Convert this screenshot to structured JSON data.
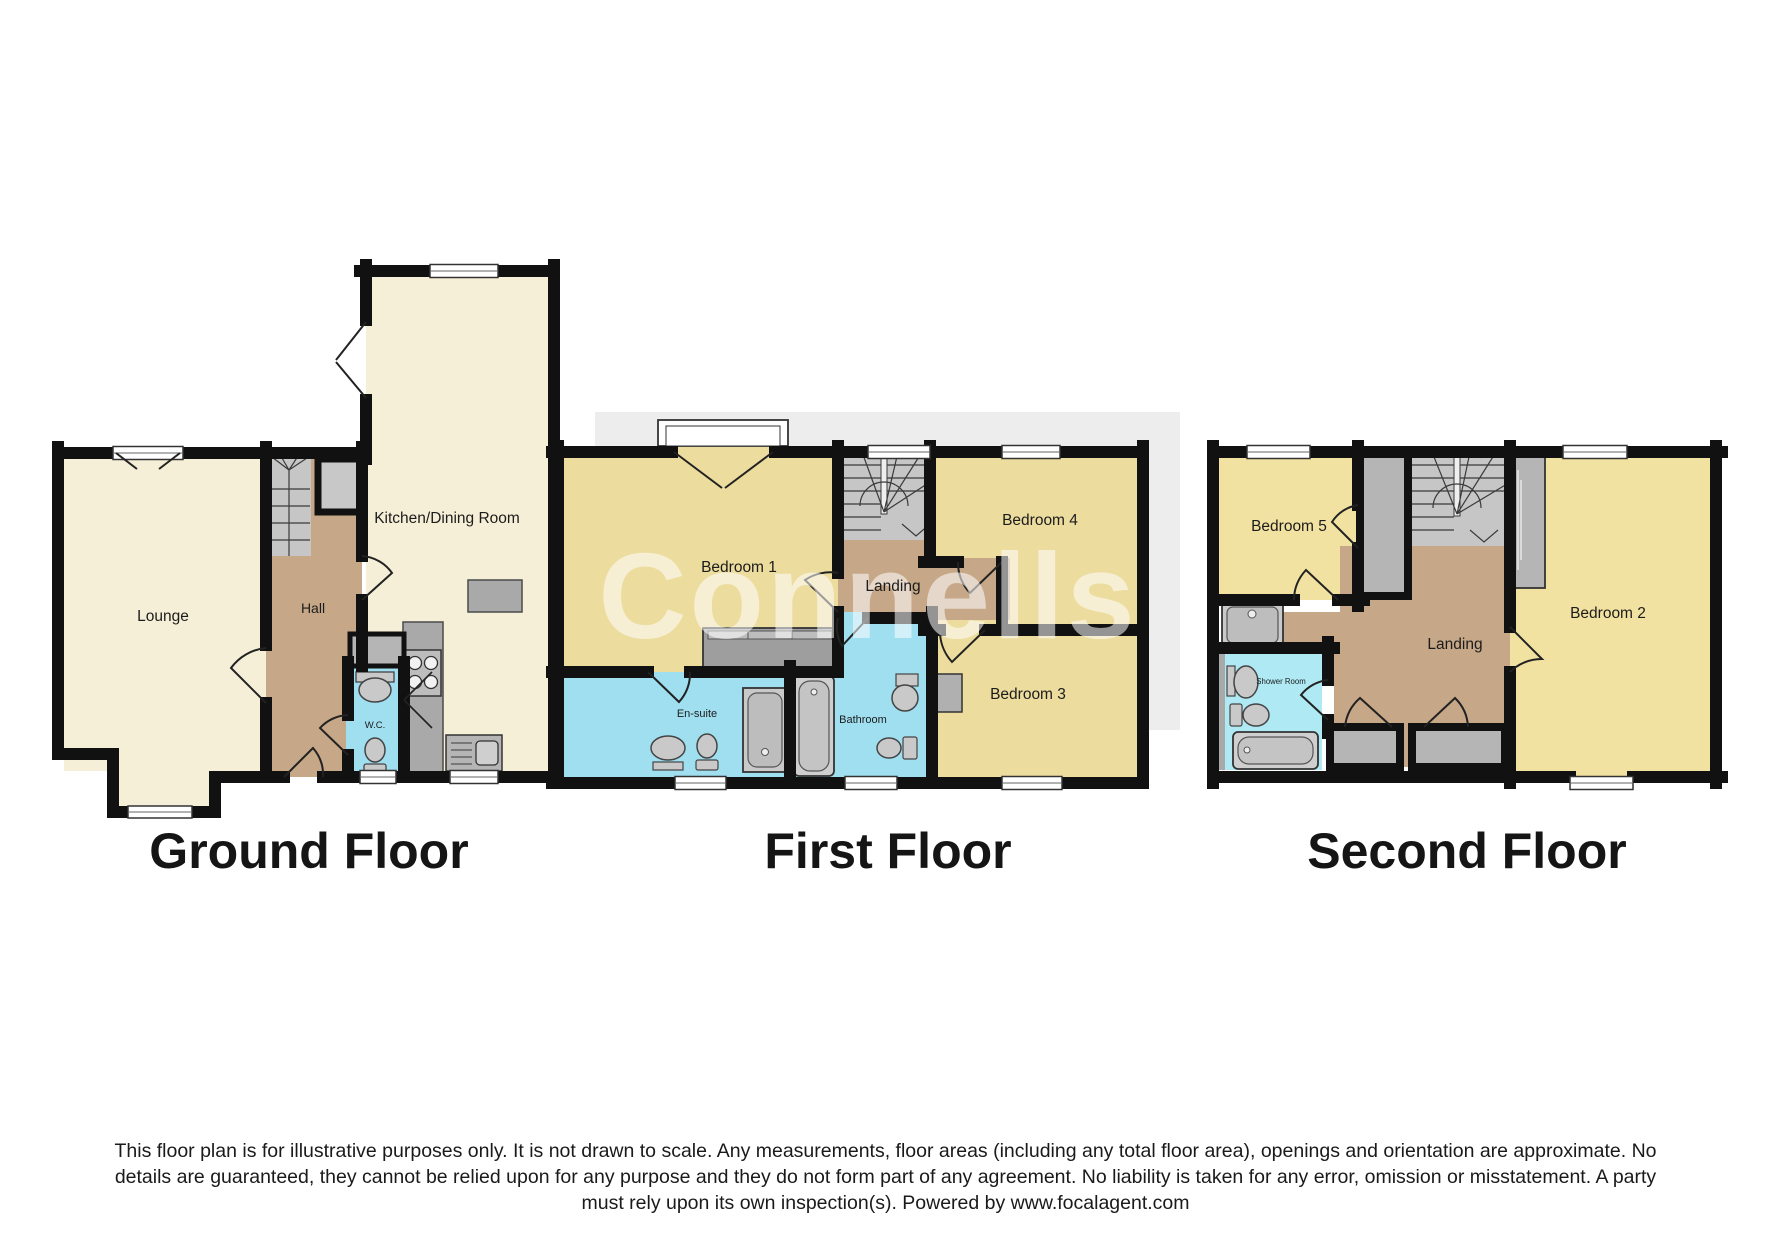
{
  "watermark": "Connells",
  "floors": [
    {
      "title": "Ground Floor",
      "rooms": {
        "lounge": "Lounge",
        "hall": "Hall",
        "wc": "W.C.",
        "kitchen": "Kitchen/Dining Room"
      }
    },
    {
      "title": "First Floor",
      "rooms": {
        "bedroom1": "Bedroom 1",
        "landing": "Landing",
        "bedroom4": "Bedroom 4",
        "bedroom3": "Bedroom 3",
        "ensuite": "En-suite",
        "bathroom": "Bathroom"
      }
    },
    {
      "title": "Second Floor",
      "rooms": {
        "bedroom5": "Bedroom 5",
        "landing": "Landing",
        "bedroom2": "Bedroom 2",
        "shower": "Shower Room"
      }
    }
  ],
  "disclaimer": [
    "This floor plan is for illustrative purposes only. It is not drawn to scale. Any measurements, floor areas (including any total floor area), openings and orientation are approximate. No",
    "details are guaranteed, they cannot be relied upon for any purpose and they do not form part of any agreement. No liability is taken for any error, omission or misstatement. A party",
    "must rely upon its own inspection(s). Powered by www.focalagent.com"
  ],
  "colors": {
    "room_cream": "#f6efd7",
    "room_yellow": "#ecdc9e",
    "room_yellow2": "#f2e2a1",
    "hall_brown": "#c6a787",
    "bath_cyan": "#9fdff0",
    "shower_cyan": "#aee9f4",
    "wall": "#111111",
    "stairs_gray": "#c6c6c6",
    "fixture_gray": "#a9a9a9",
    "wardrobe_gray": "#9e9e9e",
    "backdrop": "#ededed"
  }
}
